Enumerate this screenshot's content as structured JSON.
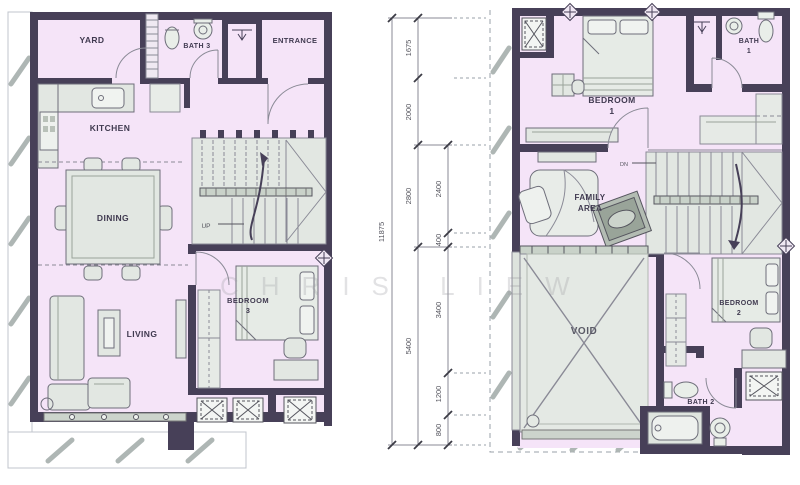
{
  "palette": {
    "wall": "#474058",
    "room_fill": "#f5e4f8",
    "furniture_fill": "#e2e7e2",
    "furniture_stroke": "#6e6e7a",
    "window_gray": "#ccd4cc",
    "hatch": "#aeb6b4",
    "dimension_line": "#55555e",
    "watermark": "#9a9aa0"
  },
  "watermark": "CHRIS LIEW",
  "left_plan": {
    "labels": {
      "yard": "YARD",
      "bath3": "BATH 3",
      "entrance": "ENTRANCE",
      "kitchen": "KITCHEN",
      "dining": "DINING",
      "living": "LIVING",
      "bedroom3_line1": "BEDROOM",
      "bedroom3_line2": "3",
      "up": "UP"
    }
  },
  "right_plan": {
    "labels": {
      "bedroom1_line1": "BEDROOM",
      "bedroom1_line2": "1",
      "bath1_line1": "BATH",
      "bath1_line2": "1",
      "family_line1": "FAMILY",
      "family_line2": "AREA",
      "void": "VOID",
      "bedroom2_line1": "BEDROOM",
      "bedroom2_line2": "2",
      "bath2": "BATH 2",
      "dn": "DN"
    }
  },
  "dimensions": {
    "total": "11875",
    "outer": [
      "1675",
      "2000",
      "2800",
      "5400"
    ],
    "inner": [
      "2400",
      "400",
      "3400",
      "1200",
      "800"
    ]
  }
}
